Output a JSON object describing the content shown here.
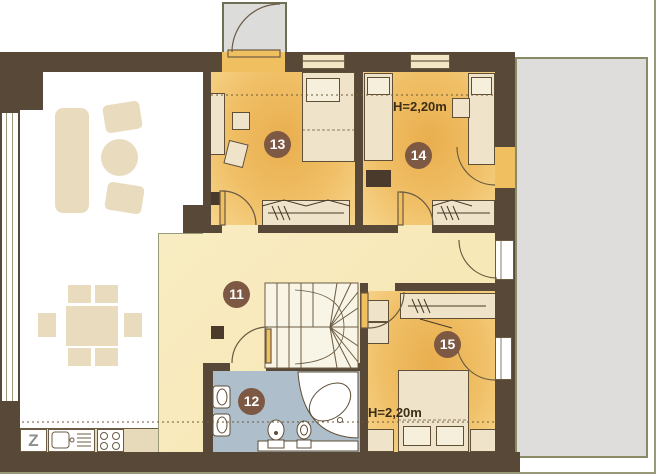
{
  "plan": {
    "rooms": [
      {
        "number": "11"
      },
      {
        "number": "12"
      },
      {
        "number": "13"
      },
      {
        "number": "14"
      },
      {
        "number": "15"
      }
    ],
    "annotations": {
      "height_room14": "H=2,20m",
      "height_room15": "H=2,20m"
    },
    "kitchen": {
      "appliance_label": "Z"
    },
    "colors": {
      "wall": "#584838",
      "bedroom_floor": "#eeb65c",
      "hall_floor": "#f8ecc0",
      "bathroom_floor": "#aebecb",
      "terrace": "#dedddb",
      "balcony": "#dcdcda",
      "void_furniture": "#e9dcbe",
      "room_furniture": "#efe4ca",
      "door": "#f0c060",
      "label_circle": "#7d5843",
      "frame": "#98987a"
    }
  }
}
